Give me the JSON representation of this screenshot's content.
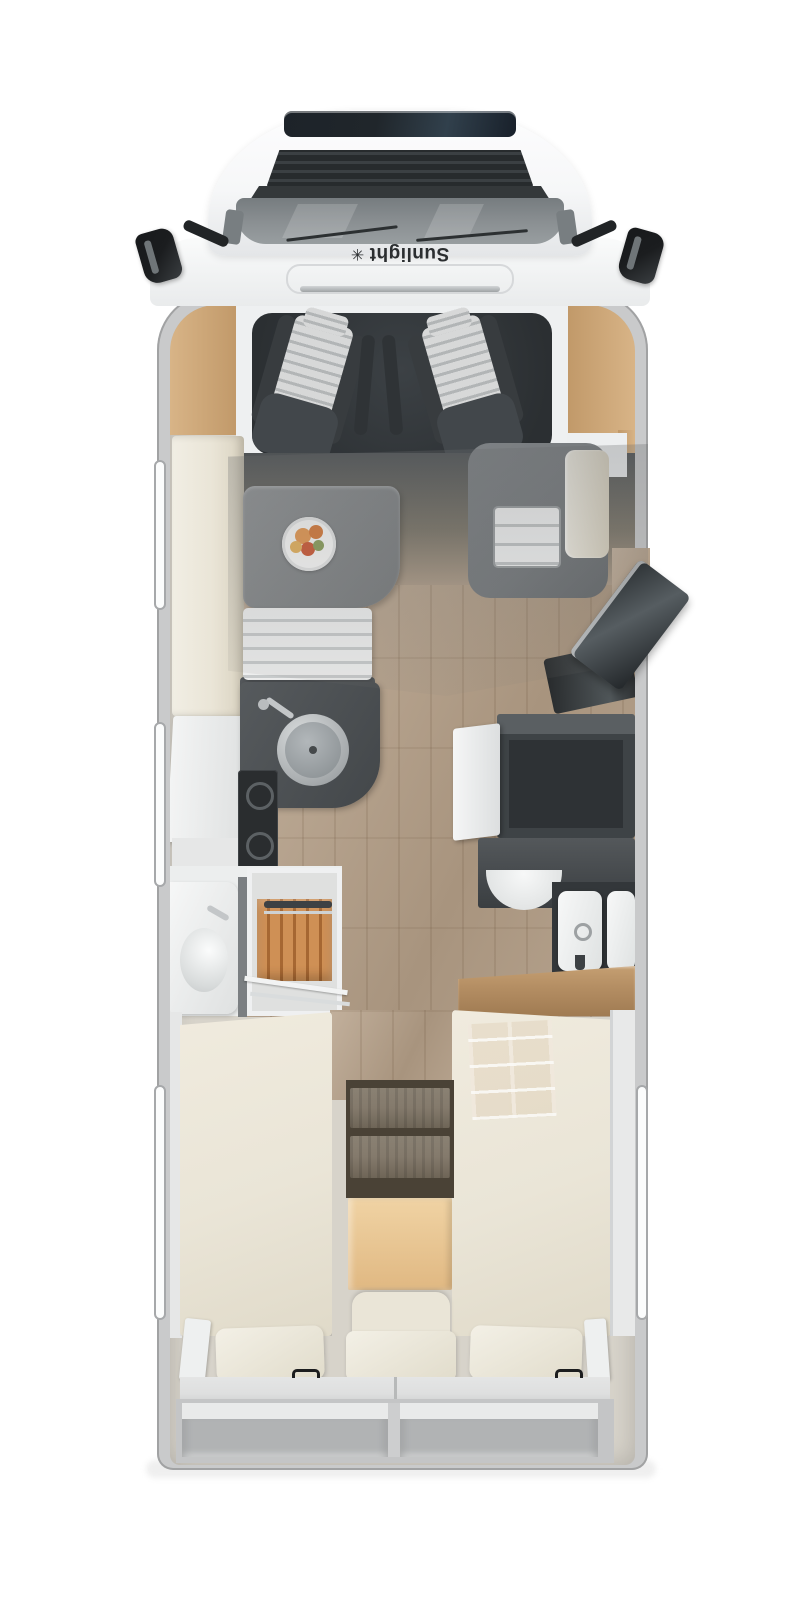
{
  "vehicle": {
    "brand": "Sunlight",
    "logo_glyph": "✳",
    "type": "motorhome-floorplan-top-view"
  },
  "palette": {
    "bg": "#ffffff",
    "body-shell": "#c9cacb",
    "interior-base": "#d7d3ca",
    "hood-white": "#f6f7f8",
    "sunroof": "#20262b",
    "grille": "#2d3133",
    "windshield": "#8b9093",
    "wiper": "#2c3032",
    "mirror": "#1b1d1f",
    "logo-text": "#2b2e30",
    "wood-trim": "#d8b487",
    "wood-trim-dark": "#c09868",
    "cab-floor": "#34383b",
    "seat-dark": "#42474b",
    "seat-bolster": "#383c3f",
    "stripe-light": "#d7d8d8",
    "stripe-dark": "#b2b5b6",
    "cream": "#eae5d7",
    "cream-shade": "#d9d2c0",
    "cream-light": "#f1eee4",
    "table-gray": "#85888a",
    "bench-light": "#edeeee",
    "bench-dark": "#c7cacb",
    "floor-wood": "#b5a28e",
    "floor-wood-dark": "#9d8a74",
    "counter-dark": "#4a4e51",
    "hob-dark": "#2a2d2f",
    "sink-rim": "#c4c7c9",
    "sink-bowl": "#979da0",
    "chrome": "#c3c6c8",
    "cabinet-dark": "#3e4346",
    "white-door": "#f1f2f3",
    "teak": "#cf9055",
    "teak-dark": "#a66732",
    "white-fixture": "#f4f5f5",
    "wood-counter": "#b58f64",
    "step-wood": "#f0d3a4",
    "step-wood-dark": "#e0b882",
    "shelf-dark": "#4a4236",
    "tread-wood": "#847a6c",
    "mattress-base": "#dedfdf",
    "storage-gray": "#c4c5c6",
    "storage-inner": "#b1b3b4",
    "storage-light": "#e9eaea",
    "handle-black": "#1c1d1e",
    "window-white": "#fbfcfc",
    "window-frame": "#a6a8aa",
    "fruit-orange": "#e89a52",
    "fruit-deep": "#d97b3a",
    "fruit-red": "#cf5a36",
    "fruit-yellow": "#e8b45e",
    "fruit-green": "#8ca05c",
    "ground-shadow": "#efefef",
    "gray-surround": "#74787b"
  },
  "areas": {
    "cab": [
      "sunroof",
      "grille",
      "windshield",
      "wipers",
      "side-mirrors",
      "swivel-seat-left",
      "swivel-seat-right"
    ],
    "lounge": [
      "sideboard",
      "dinette-table",
      "fruit-plate",
      "bench-seat",
      "entry-steps",
      "entry-door-open"
    ],
    "kitchen": [
      "round-sink",
      "faucet",
      "gas-hob",
      "l-counter",
      "fridge-door-open",
      "tall-cabinet"
    ],
    "bathroom": [
      "washbasin",
      "teak-shower-floor",
      "towel-rail",
      "glass-door"
    ],
    "toilet-room": [
      "half-basin",
      "toilet-cassettes",
      "wood-counter"
    ],
    "bedroom": [
      "single-bed-left",
      "single-bed-right",
      "under-bed-shelf",
      "shelf-steps",
      "wood-step-platform",
      "upholstered-step",
      "pillows",
      "grab-handles"
    ],
    "rear": [
      "storage-compartment-left",
      "storage-compartment-right"
    ]
  }
}
